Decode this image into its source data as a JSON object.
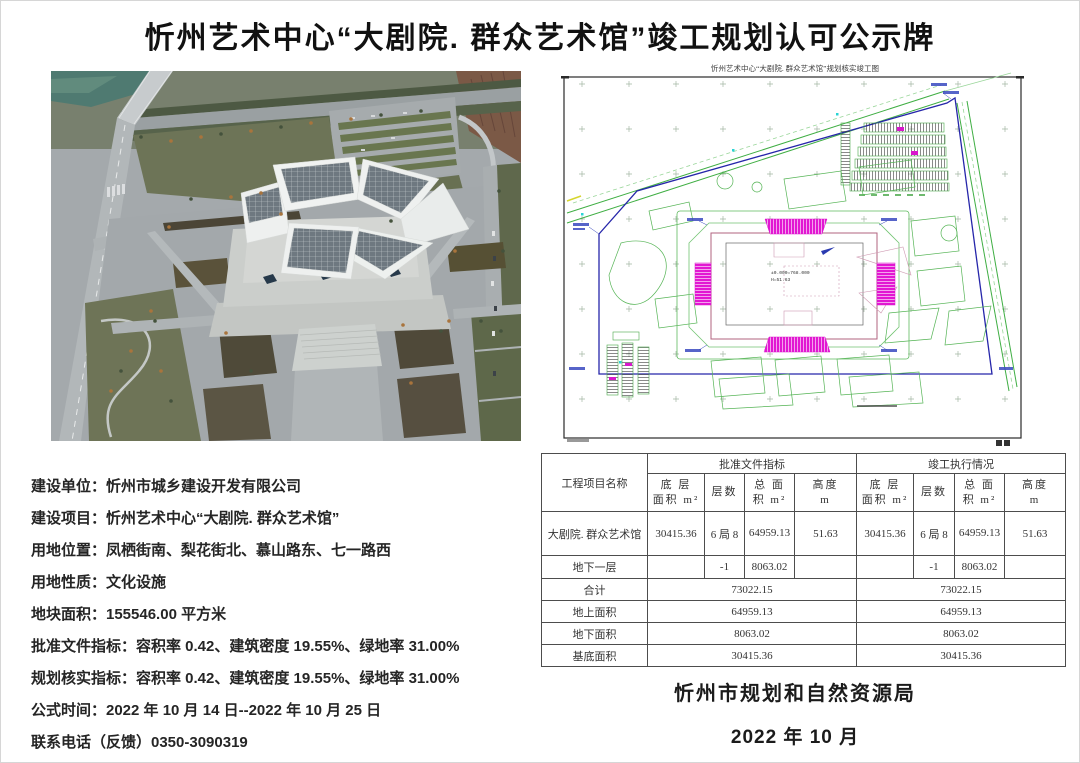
{
  "page": {
    "title": "忻州艺术中心“大剧院. 群众艺术馆”竣工规划认可公示牌"
  },
  "plan": {
    "title": "忻州艺术中心“大剧院. 群众艺术馆”规划核实竣工图",
    "level_label": "±0.000=768.000",
    "height_label": "H=51.63"
  },
  "info": {
    "lines": [
      "建设单位：忻州市城乡建设开发有限公司",
      "建设项目：忻州艺术中心“大剧院. 群众艺术馆”",
      "用地位置：凤栖街南、梨花街北、慕山路东、七一路西",
      "用地性质：文化设施",
      "地块面积：155546.00 平方米",
      "批准文件指标：容积率 0.42、建筑密度 19.55%、绿地率 31.00%",
      "规划核实指标：容积率 0.42、建筑密度 19.55%、绿地率 31.00%",
      "公式时间：2022 年 10 月 14 日--2022 年 10 月 25 日",
      "联系电话（反馈）0350-3090319"
    ]
  },
  "table": {
    "col_project": "工程项目名称",
    "group_approved": "批准文件指标",
    "group_completed": "竣工执行情况",
    "sub": [
      {
        "l1": "底 层",
        "l2": "面积 m²"
      },
      {
        "l1": "层数",
        "l2": ""
      },
      {
        "l1": "总 面",
        "l2": "积 m²"
      },
      {
        "l1": "高度",
        "l2": "m"
      }
    ],
    "rows": [
      {
        "name": "大剧院. 群众艺术馆",
        "approved": [
          "30415.36",
          "6 局 8",
          "64959.13",
          "51.63"
        ],
        "completed": [
          "30415.36",
          "6 局 8",
          "64959.13",
          "51.63"
        ]
      },
      {
        "name": "地下一层",
        "approved": [
          "",
          "-1",
          "8063.02",
          ""
        ],
        "completed": [
          "",
          "-1",
          "8063.02",
          ""
        ]
      }
    ],
    "summary": [
      {
        "name": "合计",
        "approved": "73022.15",
        "completed": "73022.15"
      },
      {
        "name": "地上面积",
        "approved": "64959.13",
        "completed": "64959.13"
      },
      {
        "name": "地下面积",
        "approved": "8063.02",
        "completed": "8063.02"
      },
      {
        "name": "基底面积",
        "approved": "30415.36",
        "completed": "30415.36"
      }
    ]
  },
  "footer": {
    "authority": "忻州市规划和自然资源局",
    "date": "2022 年 10 月"
  }
}
